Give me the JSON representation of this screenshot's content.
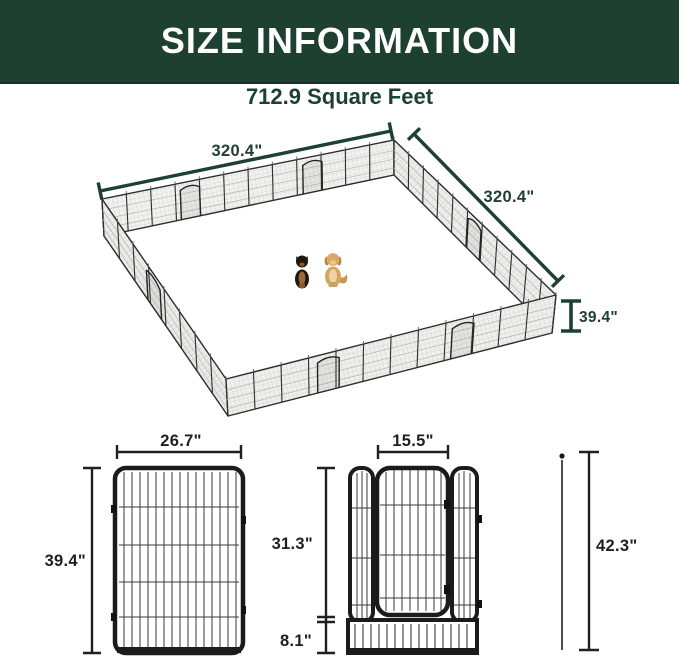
{
  "header": {
    "title": "SIZE INFORMATION"
  },
  "subtitle": {
    "area": "712.9 Square Feet"
  },
  "pen": {
    "dim_left": "320.4\"",
    "dim_right": "320.4\"",
    "dim_height": "39.4\""
  },
  "panel_diagram": {
    "width_label": "26.7\"",
    "height_label": "39.4\""
  },
  "door_diagram": {
    "door_width_label": "15.5\"",
    "door_height_label": "31.3\"",
    "bottom_height_label": "8.1\"",
    "stake_length_label": "42.3\""
  },
  "colors": {
    "banner_green": "#1e4031",
    "dimension_green": "#1e4031",
    "diagram_line_dark": "#1d1d1b",
    "title_text": "#ffffff"
  }
}
